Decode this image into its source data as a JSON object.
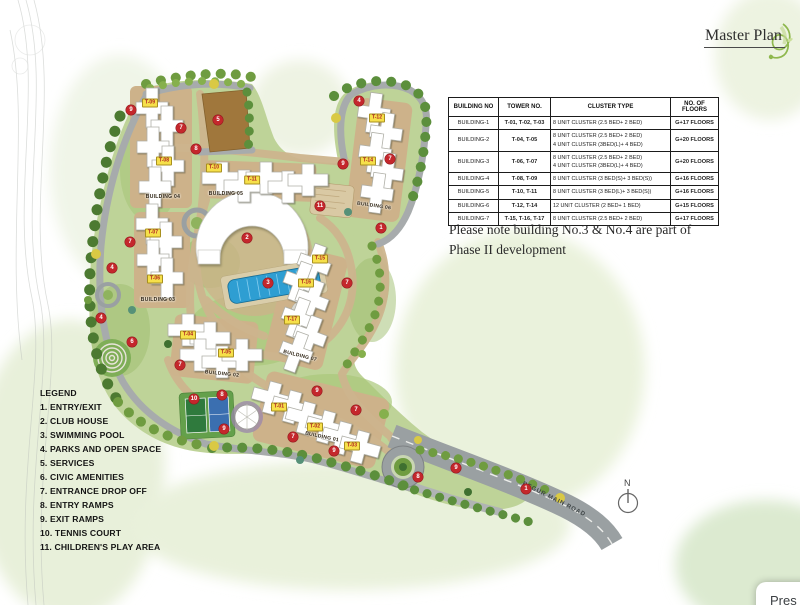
{
  "page": {
    "title": "Master Plan",
    "popup_text": "Pres"
  },
  "note": {
    "line1": "Please note building No.3 & No.4 are part of",
    "line2": "Phase II development"
  },
  "compass": {
    "label": "N"
  },
  "road": {
    "label": "BEGUR MAIN ROAD"
  },
  "table": {
    "headers": [
      "BUILDING NO",
      "TOWER NO.",
      "CLUSTER TYPE",
      "NO. OF FLOORS"
    ],
    "rows": [
      {
        "building": "BUILDING-1",
        "towers": "T-01, T-02, T-03",
        "clusters": [
          "8 UNIT CLUSTER (2.5 BED+ 2 BED)"
        ],
        "floors": "G+17 FLOORS"
      },
      {
        "building": "BUILDING-2",
        "towers": "T-04, T-05",
        "clusters": [
          "8 UNIT CLUSTER (2.5 BED+ 2 BED)",
          "4 UNIT CLUSTER (3BED(L)+ 4 BED)"
        ],
        "floors": "G+20 FLOORS"
      },
      {
        "building": "BUILDING-3",
        "towers": "T-06, T-07",
        "clusters": [
          "8 UNIT CLUSTER (2.5 BED+ 2 BED)",
          "4 UNIT CLUSTER (3BED(L)+ 4 BED)"
        ],
        "floors": "G+20 FLOORS"
      },
      {
        "building": "BUILDING-4",
        "towers": "T-08, T-09",
        "clusters": [
          "8 UNIT CLUSTER (3 BED(S)+ 3 BED(S))"
        ],
        "floors": "G+16 FLOORS"
      },
      {
        "building": "BUILDING-5",
        "towers": "T-10, T-11",
        "clusters": [
          "8 UNIT CLUSTER (3 BED(L)+ 3 BED(S))"
        ],
        "floors": "G+16 FLOORS"
      },
      {
        "building": "BUILDING-6",
        "towers": "T-12, T-14",
        "clusters": [
          "12 UNIT CLUSTER (2 BED+ 1 BED)"
        ],
        "floors": "G+15 FLOORS"
      },
      {
        "building": "BUILDING-7",
        "towers": "T-15, T-16, T-17",
        "clusters": [
          "8 UNIT CLUSTER (2.5 BED+ 2 BED)"
        ],
        "floors": "G+17 FLOORS"
      }
    ]
  },
  "legend": {
    "title": "LEGEND",
    "items": [
      "1. ENTRY/EXIT",
      "2. CLUB HOUSE",
      "3. SWIMMING POOL",
      "4. PARKS AND OPEN SPACE",
      "5. SERVICES",
      "6. CIVIC AMENITIES",
      "7. ENTRANCE DROP OFF",
      "8. ENTRY RAMPS",
      "9. EXIT RAMPS",
      "10. TENNIS COURT",
      "11. CHILDREN'S PLAY AREA"
    ]
  },
  "map": {
    "colors": {
      "marker_red": "#c4272c",
      "tag_yellow": "#f6e04a",
      "tag_text": "#b01f24",
      "estate_green": "#bed398",
      "road_gray": "#a7abac",
      "road_tan": "#cdb58e",
      "plaza_tan": "#cdb28a",
      "services_brown": "#a0773c",
      "pool_blue": "#2e9ed2",
      "building_white": "#ffffff"
    },
    "markers": [
      {
        "n": "9",
        "x": 131,
        "y": 110
      },
      {
        "n": "7",
        "x": 181,
        "y": 128
      },
      {
        "n": "8",
        "x": 196,
        "y": 149
      },
      {
        "n": "5",
        "x": 218,
        "y": 120
      },
      {
        "n": "4",
        "x": 359,
        "y": 101
      },
      {
        "n": "9",
        "x": 343,
        "y": 164
      },
      {
        "n": "7",
        "x": 390,
        "y": 159
      },
      {
        "n": "1",
        "x": 381,
        "y": 228
      },
      {
        "n": "11",
        "x": 320,
        "y": 206
      },
      {
        "n": "2",
        "x": 247,
        "y": 238
      },
      {
        "n": "3",
        "x": 268,
        "y": 283
      },
      {
        "n": "7",
        "x": 130,
        "y": 242
      },
      {
        "n": "4",
        "x": 112,
        "y": 268
      },
      {
        "n": "4",
        "x": 101,
        "y": 318
      },
      {
        "n": "6",
        "x": 132,
        "y": 342
      },
      {
        "n": "7",
        "x": 180,
        "y": 365
      },
      {
        "n": "7",
        "x": 347,
        "y": 283
      },
      {
        "n": "10",
        "x": 194,
        "y": 399
      },
      {
        "n": "8",
        "x": 222,
        "y": 395
      },
      {
        "n": "9",
        "x": 224,
        "y": 429
      },
      {
        "n": "9",
        "x": 317,
        "y": 391
      },
      {
        "n": "7",
        "x": 356,
        "y": 410
      },
      {
        "n": "7",
        "x": 293,
        "y": 437
      },
      {
        "n": "9",
        "x": 334,
        "y": 451
      },
      {
        "n": "8",
        "x": 418,
        "y": 477
      },
      {
        "n": "9",
        "x": 456,
        "y": 468
      },
      {
        "n": "1",
        "x": 526,
        "y": 489
      }
    ],
    "tower_tags": [
      {
        "label": "T-09",
        "x": 150,
        "y": 103
      },
      {
        "label": "T-08",
        "x": 164,
        "y": 161
      },
      {
        "label": "T-10",
        "x": 214,
        "y": 168
      },
      {
        "label": "T-11",
        "x": 252,
        "y": 180
      },
      {
        "label": "T-12",
        "x": 377,
        "y": 118
      },
      {
        "label": "T-14",
        "x": 368,
        "y": 161
      },
      {
        "label": "T-07",
        "x": 153,
        "y": 233
      },
      {
        "label": "T-06",
        "x": 155,
        "y": 279
      },
      {
        "label": "T-04",
        "x": 188,
        "y": 335
      },
      {
        "label": "T-05",
        "x": 226,
        "y": 353
      },
      {
        "label": "T-15",
        "x": 320,
        "y": 259
      },
      {
        "label": "T-16",
        "x": 306,
        "y": 283
      },
      {
        "label": "T-17",
        "x": 292,
        "y": 320
      },
      {
        "label": "T-01",
        "x": 279,
        "y": 407
      },
      {
        "label": "T-02",
        "x": 315,
        "y": 427
      },
      {
        "label": "T-03",
        "x": 352,
        "y": 446
      }
    ],
    "building_labels": [
      {
        "label": "BUILDING 04",
        "x": 163,
        "y": 197,
        "rot": 0
      },
      {
        "label": "BUILDING 05",
        "x": 226,
        "y": 194,
        "rot": 0
      },
      {
        "label": "BUILDING 06",
        "x": 374,
        "y": 206,
        "rot": 8
      },
      {
        "label": "BUILDING 03",
        "x": 158,
        "y": 300,
        "rot": 0
      },
      {
        "label": "BUILDING 02",
        "x": 222,
        "y": 374,
        "rot": 6
      },
      {
        "label": "BUILDING 07",
        "x": 300,
        "y": 356,
        "rot": 14
      },
      {
        "label": "BUILDING 01",
        "x": 322,
        "y": 437,
        "rot": 12
      }
    ]
  }
}
